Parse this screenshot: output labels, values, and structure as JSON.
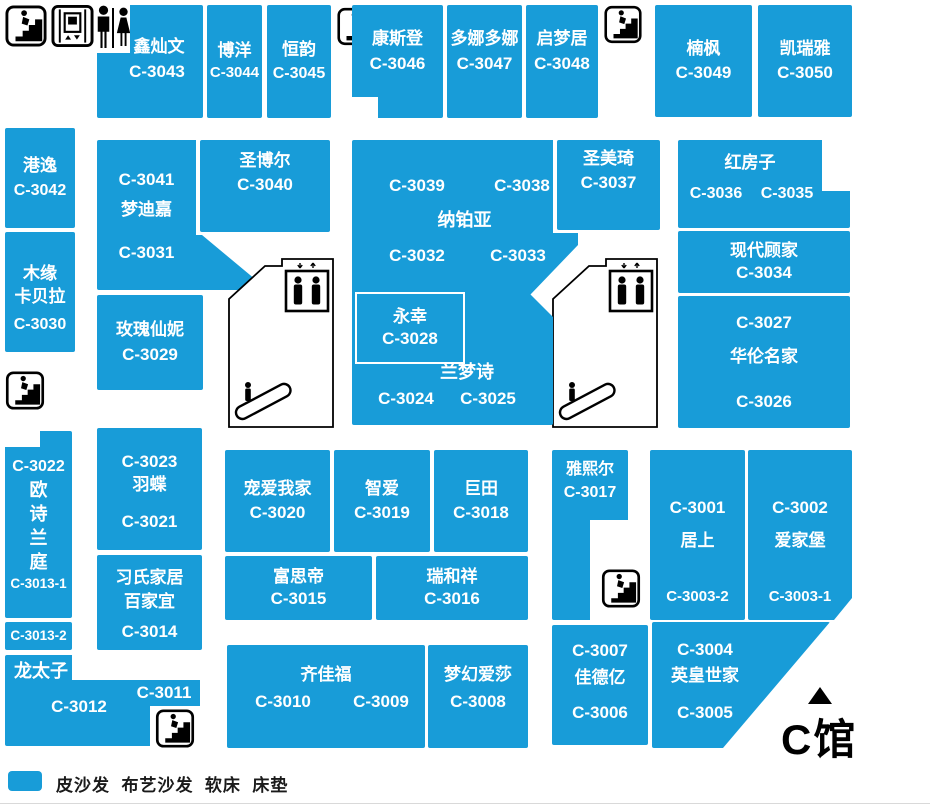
{
  "hall_label": "C馆",
  "legend": {
    "text": "皮沙发  布艺沙发  软床  床垫"
  },
  "colors": {
    "unit_fill": "#189CD8",
    "unit_text": "#FFFFFF",
    "outline": "#000000"
  },
  "icons": [
    "stairs-icon",
    "elevator-icon",
    "mens-restroom-icon",
    "womens-restroom-icon",
    "elevator-cab-icon",
    "escalator-icon",
    "north-triangle-icon"
  ],
  "stores": {
    "c3043": {
      "lines": [
        "鑫灿文",
        "C-3043"
      ]
    },
    "c3044": {
      "lines": [
        "博洋",
        "C-3044"
      ]
    },
    "c3045": {
      "lines": [
        "恒韵",
        "C-3045"
      ]
    },
    "c3046": {
      "lines": [
        "康斯登",
        "C-3046"
      ]
    },
    "c3047": {
      "lines": [
        "多娜多娜",
        "C-3047"
      ]
    },
    "c3048": {
      "lines": [
        "启梦居",
        "C-3048"
      ]
    },
    "c3049": {
      "lines": [
        "楠枫",
        "C-3049"
      ]
    },
    "c3050": {
      "lines": [
        "凯瑞雅",
        "C-3050"
      ]
    },
    "c3042": {
      "lines": [
        "港逸",
        "C-3042"
      ]
    },
    "c3030": {
      "lines": [
        "木缘",
        "卡贝拉",
        "C-3030"
      ]
    },
    "c3041": {
      "lines": [
        "C-3041",
        "梦迪嘉",
        "C-3031"
      ]
    },
    "c3040": {
      "lines": [
        "圣博尔",
        "C-3040"
      ]
    },
    "nabaiya": {
      "lines": [
        "C-3039",
        "C-3038",
        "纳铂亚",
        "C-3032",
        "C-3033"
      ]
    },
    "c3037": {
      "lines": [
        "圣美琦",
        "C-3037"
      ]
    },
    "redhouse": {
      "lines": [
        "红房子",
        "C-3036",
        "C-3035"
      ]
    },
    "c3034": {
      "lines": [
        "现代顾家",
        "C-3034"
      ]
    },
    "c3027": {
      "lines": [
        "C-3027",
        "华伦名家",
        "C-3026"
      ]
    },
    "c3029": {
      "lines": [
        "玫瑰仙妮",
        "C-3029"
      ]
    },
    "c3028": {
      "lines": [
        "永幸",
        "C-3028"
      ]
    },
    "lanmengshi": {
      "lines": [
        "兰梦诗",
        "C-3024",
        "C-3025"
      ]
    },
    "c3022": {
      "lines": [
        "C-3022",
        "欧",
        "诗",
        "兰",
        "庭",
        "C-3013-1"
      ]
    },
    "c3013_2": {
      "lines": [
        "C-3013-2"
      ]
    },
    "dragon": {
      "lines": [
        "龙太子",
        "C-3012",
        "C-3011"
      ]
    },
    "c3023": {
      "lines": [
        "C-3023",
        "羽蝶",
        "C-3021"
      ]
    },
    "c3014": {
      "lines": [
        "习氏家居",
        "百家宜",
        "C-3014"
      ]
    },
    "c3020": {
      "lines": [
        "宠爱我家",
        "C-3020"
      ]
    },
    "c3019": {
      "lines": [
        "智爱",
        "C-3019"
      ]
    },
    "c3018": {
      "lines": [
        "巨田",
        "C-3018"
      ]
    },
    "c3015": {
      "lines": [
        "富思帝",
        "C-3015"
      ]
    },
    "c3016": {
      "lines": [
        "瑞和祥",
        "C-3016"
      ]
    },
    "c3017": {
      "lines": [
        "雅熙尔",
        "C-3017"
      ]
    },
    "c3001": {
      "lines": [
        "C-3001",
        "居上",
        "C-3003-2"
      ]
    },
    "c3002": {
      "lines": [
        "C-3002",
        "爱家堡",
        "C-3003-1"
      ]
    },
    "qijiafu": {
      "lines": [
        "齐佳福",
        "C-3010",
        "C-3009"
      ]
    },
    "c3008": {
      "lines": [
        "梦幻爱莎",
        "C-3008"
      ]
    },
    "c3007": {
      "lines": [
        "C-3007",
        "佳德亿",
        "C-3006"
      ]
    },
    "c3004": {
      "lines": [
        "C-3004",
        "英皇世家",
        "C-3005"
      ]
    }
  }
}
